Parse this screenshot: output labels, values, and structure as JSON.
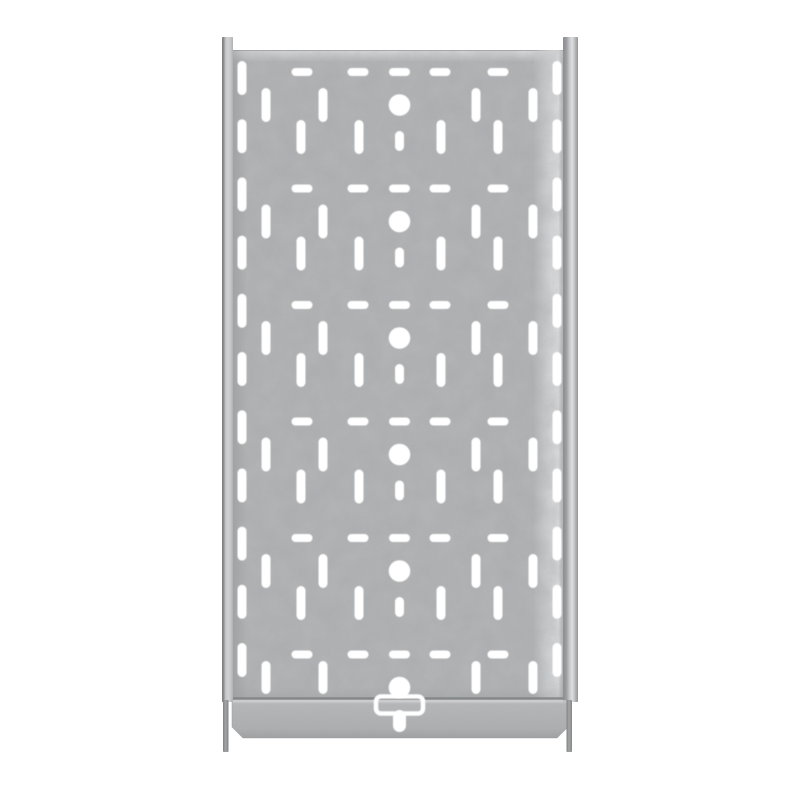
{
  "meta": {
    "title": "Galvanized perforated cable tray, top view"
  },
  "canvas": {
    "width": 800,
    "height": 800,
    "background": "#ffffff"
  },
  "tray": {
    "panel": {
      "x": 233,
      "y": 50,
      "width": 330,
      "height": 650
    },
    "left_rail": {
      "x": 222,
      "y": 37,
      "width": 11,
      "height": 665
    },
    "right_rail": {
      "x": 563,
      "y": 37,
      "width": 15,
      "height": 665
    },
    "left_tab": {
      "x": 223,
      "y": 700,
      "width": 5.5,
      "height": 52
    },
    "right_tab": {
      "x": 566.5,
      "y": 700,
      "width": 5.5,
      "height": 52
    },
    "flange": {
      "x": 232,
      "y": 700,
      "width": 336,
      "height": 38,
      "chamfer": 11
    },
    "seam": {
      "x": 233,
      "width": 330,
      "dark_y": 697.3,
      "dark_h": 2.2,
      "light_y": 699.8,
      "light_h": 2.6
    },
    "colors": {
      "hole": "#ffffff",
      "panel_base": "#b4b6b8",
      "panel_top_edge_line": "#a2a4a6",
      "seam_dark": "#7e8183",
      "seam_light": "#cbcdcf",
      "flange_edge": "#97999b",
      "noise_tint": "0.35 0.36 0.37"
    }
  },
  "gradients": [
    {
      "id": "gradLeftRail",
      "dir": [
        1,
        0
      ],
      "stops": [
        [
          0,
          "#7b7d7f",
          1
        ],
        [
          0.16,
          "#8e9092",
          1
        ],
        [
          0.32,
          "#c2c4c6",
          1
        ],
        [
          0.55,
          "#d0d2d4",
          1
        ],
        [
          0.8,
          "#c3c5c7",
          1
        ],
        [
          1,
          "#aeb0b2",
          1
        ]
      ]
    },
    {
      "id": "gradRightRail",
      "dir": [
        1,
        0
      ],
      "stops": [
        [
          0,
          "#8b8d8f",
          1
        ],
        [
          0.22,
          "#9b9da0",
          1
        ],
        [
          0.45,
          "#c8cacc",
          1
        ],
        [
          0.62,
          "#dcdee0",
          1
        ],
        [
          0.8,
          "#b9bbbd",
          1
        ],
        [
          1,
          "#939597",
          1
        ]
      ]
    },
    {
      "id": "gradTab",
      "dir": [
        1,
        0
      ],
      "stops": [
        [
          0,
          "#7e8082",
          1
        ],
        [
          0.45,
          "#a3a5a7",
          1
        ],
        [
          1,
          "#848688",
          1
        ]
      ]
    },
    {
      "id": "gradFlange",
      "dir": [
        0,
        1
      ],
      "stops": [
        [
          0,
          "#c8cacc",
          1
        ],
        [
          0.12,
          "#b5b7b9",
          1
        ],
        [
          0.75,
          "#adafb1",
          1
        ],
        [
          1,
          "#9fa1a3",
          1
        ]
      ]
    },
    {
      "id": "gradPanelTop",
      "dir": [
        0,
        1
      ],
      "stops": [
        [
          0,
          "#ffffff",
          0.6
        ],
        [
          1,
          "#ffffff",
          0
        ]
      ]
    },
    {
      "id": "gradPanelLeft",
      "dir": [
        1,
        0
      ],
      "stops": [
        [
          0,
          "#8f9193",
          0.5
        ],
        [
          1,
          "#8f9193",
          0
        ]
      ]
    },
    {
      "id": "gradPanelRight",
      "dir": [
        1,
        0
      ],
      "stops": [
        [
          0,
          "#e2e4e6",
          0
        ],
        [
          0.55,
          "#dfe1e3",
          0.8
        ],
        [
          0.85,
          "#e6e8ea",
          0.95
        ],
        [
          1,
          "#b6b8ba",
          0.6
        ]
      ]
    },
    {
      "id": "gradPanelBottom",
      "dir": [
        0,
        1
      ],
      "stops": [
        [
          0,
          "#96989a",
          0
        ],
        [
          1,
          "#96989a",
          0.4
        ]
      ]
    }
  ],
  "pattern": {
    "rows": 6,
    "row_pitch": 116.5,
    "h_row_y0": 72,
    "h_slot_centers_x": [
      302,
      358,
      399.5,
      440,
      498
    ],
    "h_slot": {
      "width": 21,
      "height": 8
    },
    "circle": {
      "cx": 399.5,
      "offset_from_h_row": 33,
      "radius": 10.8
    },
    "upper_vslot_centers_x": [
      266,
      323,
      476,
      533
    ],
    "lower_vslot_centers_x": [
      301,
      359,
      441,
      498
    ],
    "v_slot": {
      "width": 9,
      "height": 34
    },
    "upper_offset_from_h_row": 33,
    "lower_offset_from_h_row": 65,
    "stub": {
      "cx": 399.5,
      "width": 9,
      "height": 20,
      "offset_from_h_row": 69
    },
    "last_row": {
      "upper_vslot_cy": 677.5,
      "upper_vslot_height": 33
    },
    "edge_columns_x": [
      242,
      557
    ],
    "edge_slot": {
      "width": 9,
      "height": 34,
      "y0": 78,
      "pitch": 58.2,
      "count": 11
    }
  },
  "bracket": {
    "outline": {
      "x": 376,
      "y": 696.5,
      "width": 47,
      "height": 17,
      "radius": 5,
      "stroke_width": 4.5
    },
    "stem": {
      "x": 393,
      "y": 710,
      "width": 13,
      "height": 22,
      "radius": 6.5
    }
  }
}
